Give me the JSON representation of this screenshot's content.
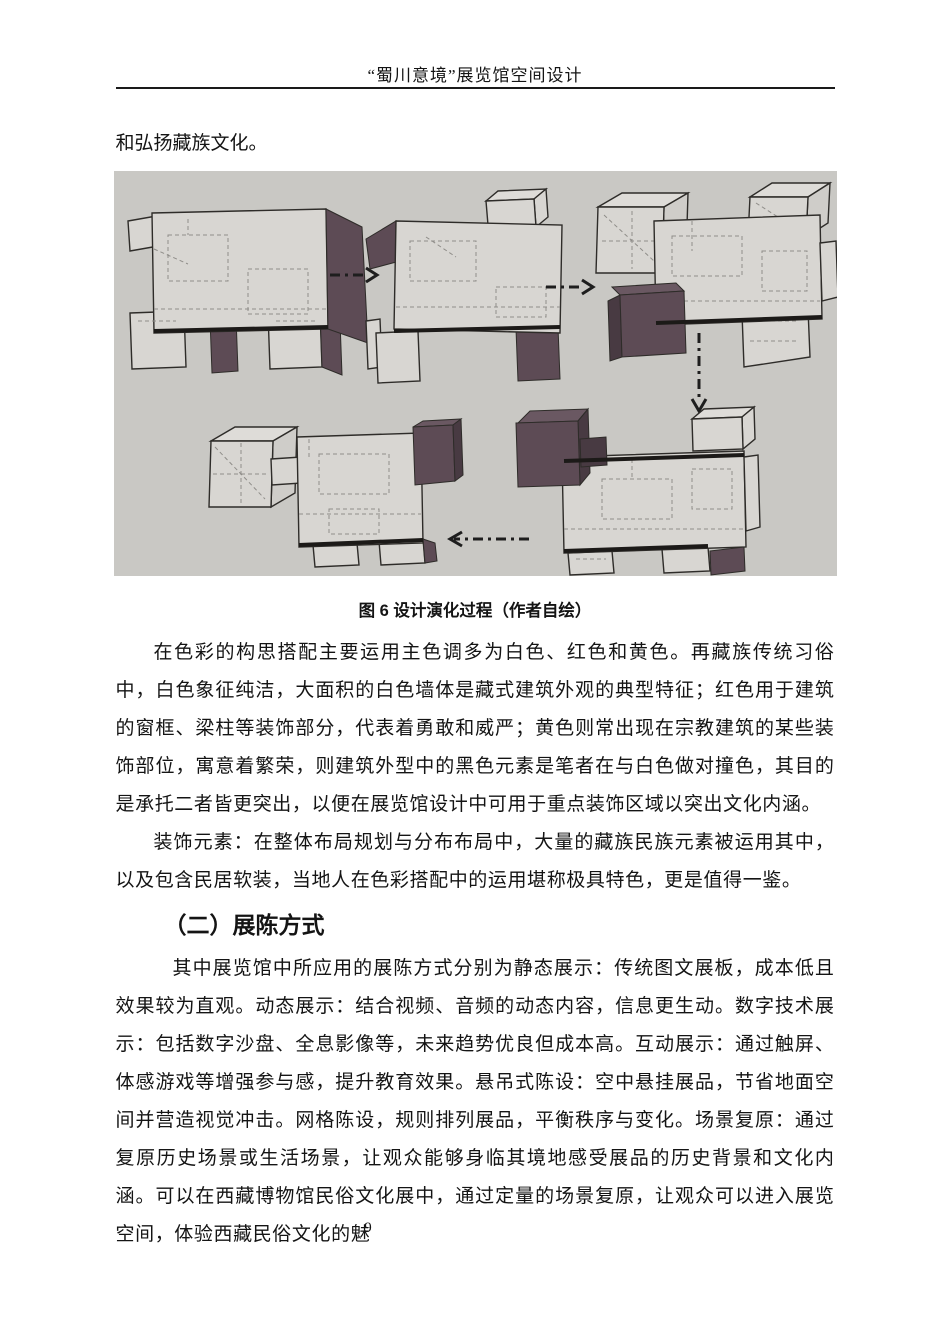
{
  "page": {
    "header_title": "“蜀川意境”展览馆空间设计",
    "page_number": "9"
  },
  "content": {
    "lead_paragraph": "和弘扬藏族文化。",
    "figure_caption": "图 6 设计演化过程（作者自绘）",
    "paragraph_color": "在色彩的构思搭配主要运用主色调多为白色、红色和黄色。再藏族传统习俗中，白色象征纯洁，大面积的白色墙体是藏式建筑外观的典型特征；红色用于建筑的窗框、梁柱等装饰部分，代表着勇敢和威严；黄色则常出现在宗教建筑的某些装饰部位，寓意着繁荣，则建筑外型中的黑色元素是笔者在与白色做对撞色，其目的是承托二者皆更突出，以便在展览馆设计中可用于重点装饰区域以突出文化内涵。",
    "paragraph_decor": "装饰元素：在整体布局规划与分布布局中，大量的藏族民族元素被运用其中，以及包含民居软装，当地人在色彩搭配中的运用堪称极具特色，更是值得一鉴。",
    "section_heading": "（二）展陈方式",
    "paragraph_display": "其中展览馆中所应用的展陈方式分别为静态展示：传统图文展板，成本低且效果较为直观。动态展示：结合视频、音频的动态内容，信息更生动。数字技术展示：包括数字沙盘、全息影像等，未来趋势优良但成本高。互动展示：通过触屏、体感游戏等增强参与感，提升教育效果。悬吊式陈设：空中悬挂展品，节省地面空间并营造视觉冲击。网格陈设，规则排列展品，平衡秩序与变化。场景复原：通过复原历史场景或生活场景，让观众能够身临其境地感受展品的历史背景和文化内涵。可以在西藏博物馆民俗文化展中，通过定量的场景复原，让观众可以进入展览空间，体验西藏民俗文化的魅"
  },
  "figure_colors": {
    "background": "#c9c8c4",
    "box_light": "#d8d6d2",
    "box_dark": "#5d4b55",
    "outline": "#2e2c29"
  }
}
